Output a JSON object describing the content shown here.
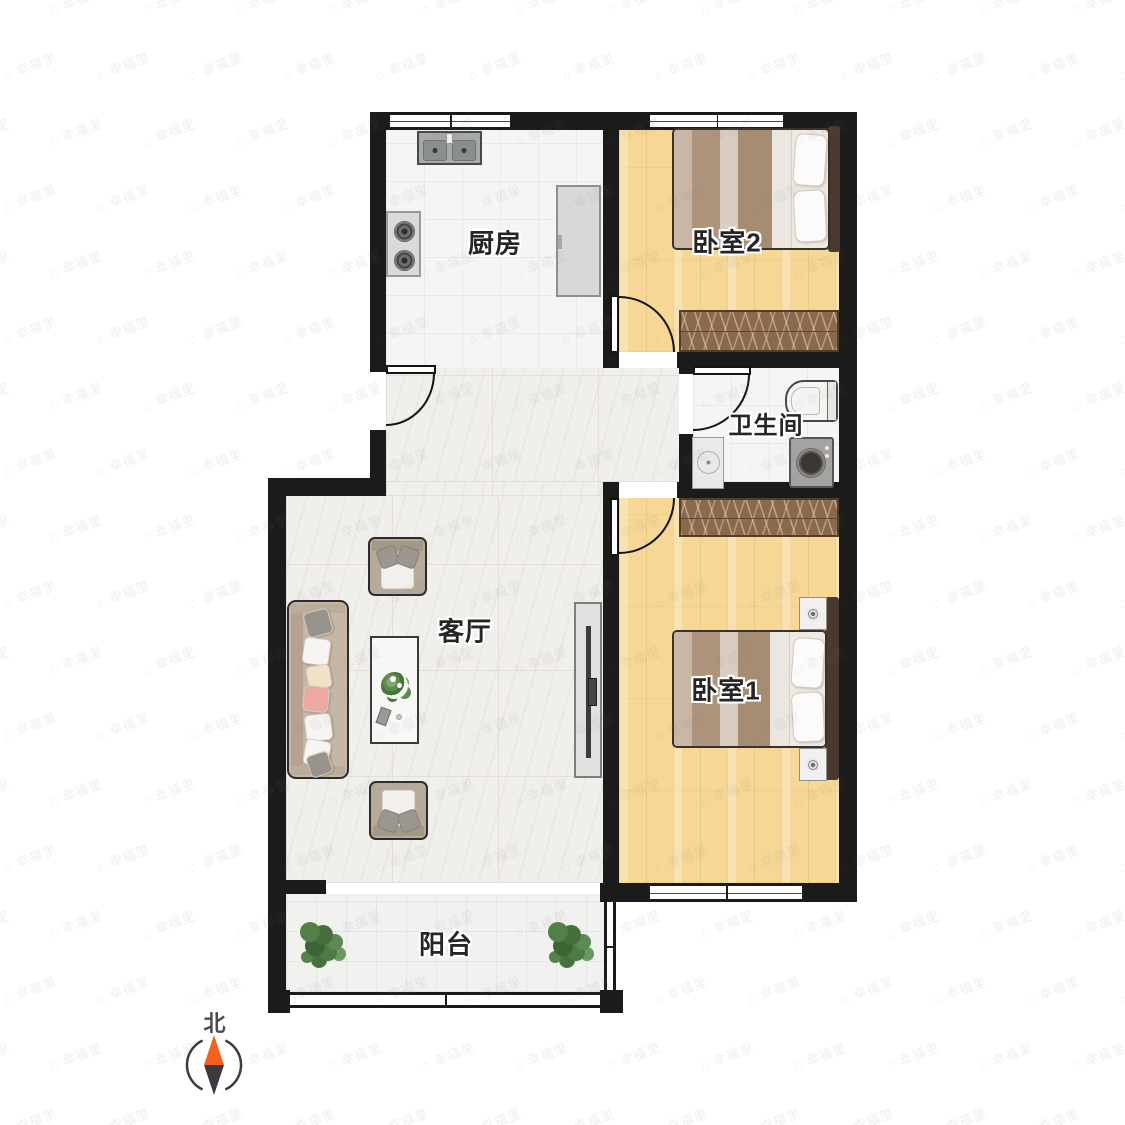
{
  "rooms": [
    {
      "id": "kitchen",
      "label": "厨房"
    },
    {
      "id": "bedroom2",
      "label": "卧室2"
    },
    {
      "id": "bathroom",
      "label": "卫生间"
    },
    {
      "id": "living-room",
      "label": "客厅"
    },
    {
      "id": "bedroom1",
      "label": "卧室1"
    },
    {
      "id": "balcony",
      "label": "阳台"
    }
  ],
  "compass": {
    "north_label": "北",
    "needle_north_color": "#f4611e",
    "needle_south_color": "#3a3a40",
    "ring_color": "#3b3b41"
  },
  "watermark": {
    "glyph": "⌂",
    "text": "幸福里",
    "color": "rgba(125,125,125,0.12)"
  },
  "palette": {
    "wall": "#1b1b1b",
    "wood_floor": "#f6d795",
    "tile_floor": "#f5f5f3",
    "marble_floor": "#f1efec",
    "balcony_floor": "#f1f1ef",
    "wardrobe": "#8a694c",
    "sofa": "#c6b7a4",
    "accent_pillow": "#eca9a1",
    "plant_green": "#528047"
  }
}
